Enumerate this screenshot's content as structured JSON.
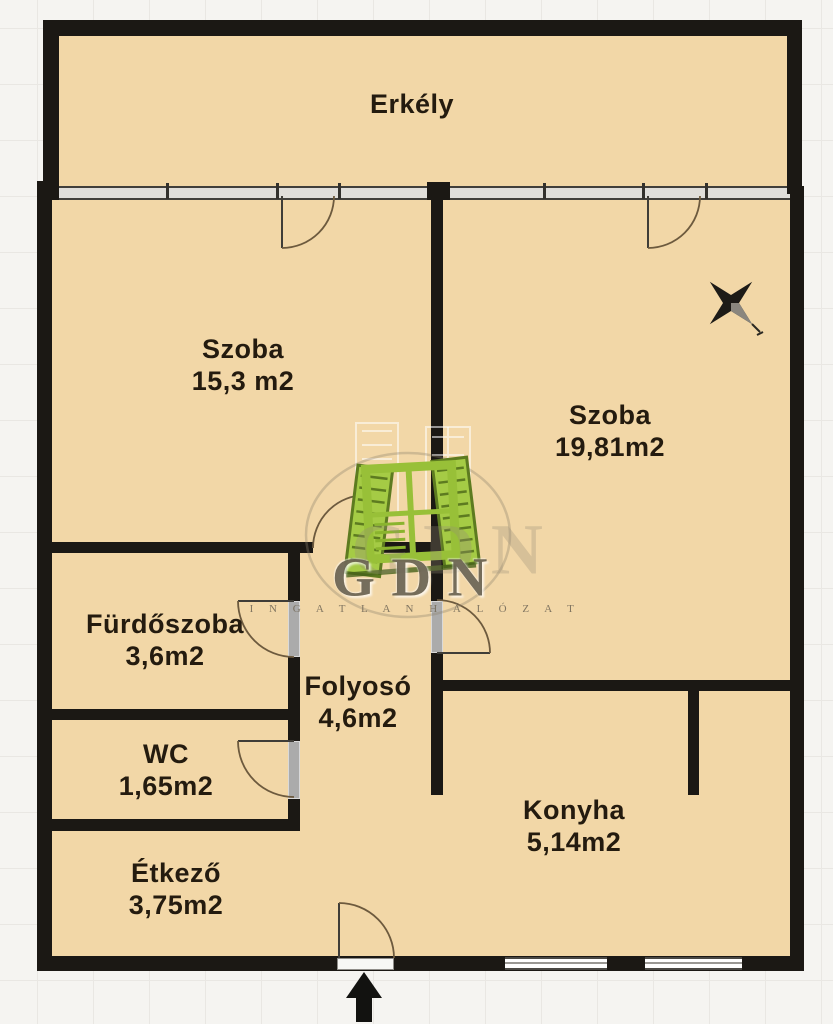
{
  "floorplan": {
    "balcony": {
      "label": "Erkély"
    },
    "rooms": [
      {
        "id": "szoba-left",
        "name": "Szoba",
        "area": "15,3 m2"
      },
      {
        "id": "szoba-right",
        "name": "Szoba",
        "area": "19,81m2"
      },
      {
        "id": "furdoszoba",
        "name": "Fürdőszoba",
        "area": "3,6m2"
      },
      {
        "id": "folyoso",
        "name": "Folyosó",
        "area": "4,6m2"
      },
      {
        "id": "wc",
        "name": "WC",
        "area": "1,65m2"
      },
      {
        "id": "konyha",
        "name": "Konyha",
        "area": "5,14m2"
      },
      {
        "id": "etkezo",
        "name": "Étkező",
        "area": "3,75m2"
      }
    ],
    "watermark": {
      "brand": "GDN",
      "network": "I N G A T L A N H Á L Ó Z A T"
    },
    "colors": {
      "floor": "#f2d7a7",
      "wall": "#1b1814",
      "background": "#f5f4f1",
      "watermark_green": "#a5cb45",
      "watermark_text": "#625a48"
    }
  }
}
